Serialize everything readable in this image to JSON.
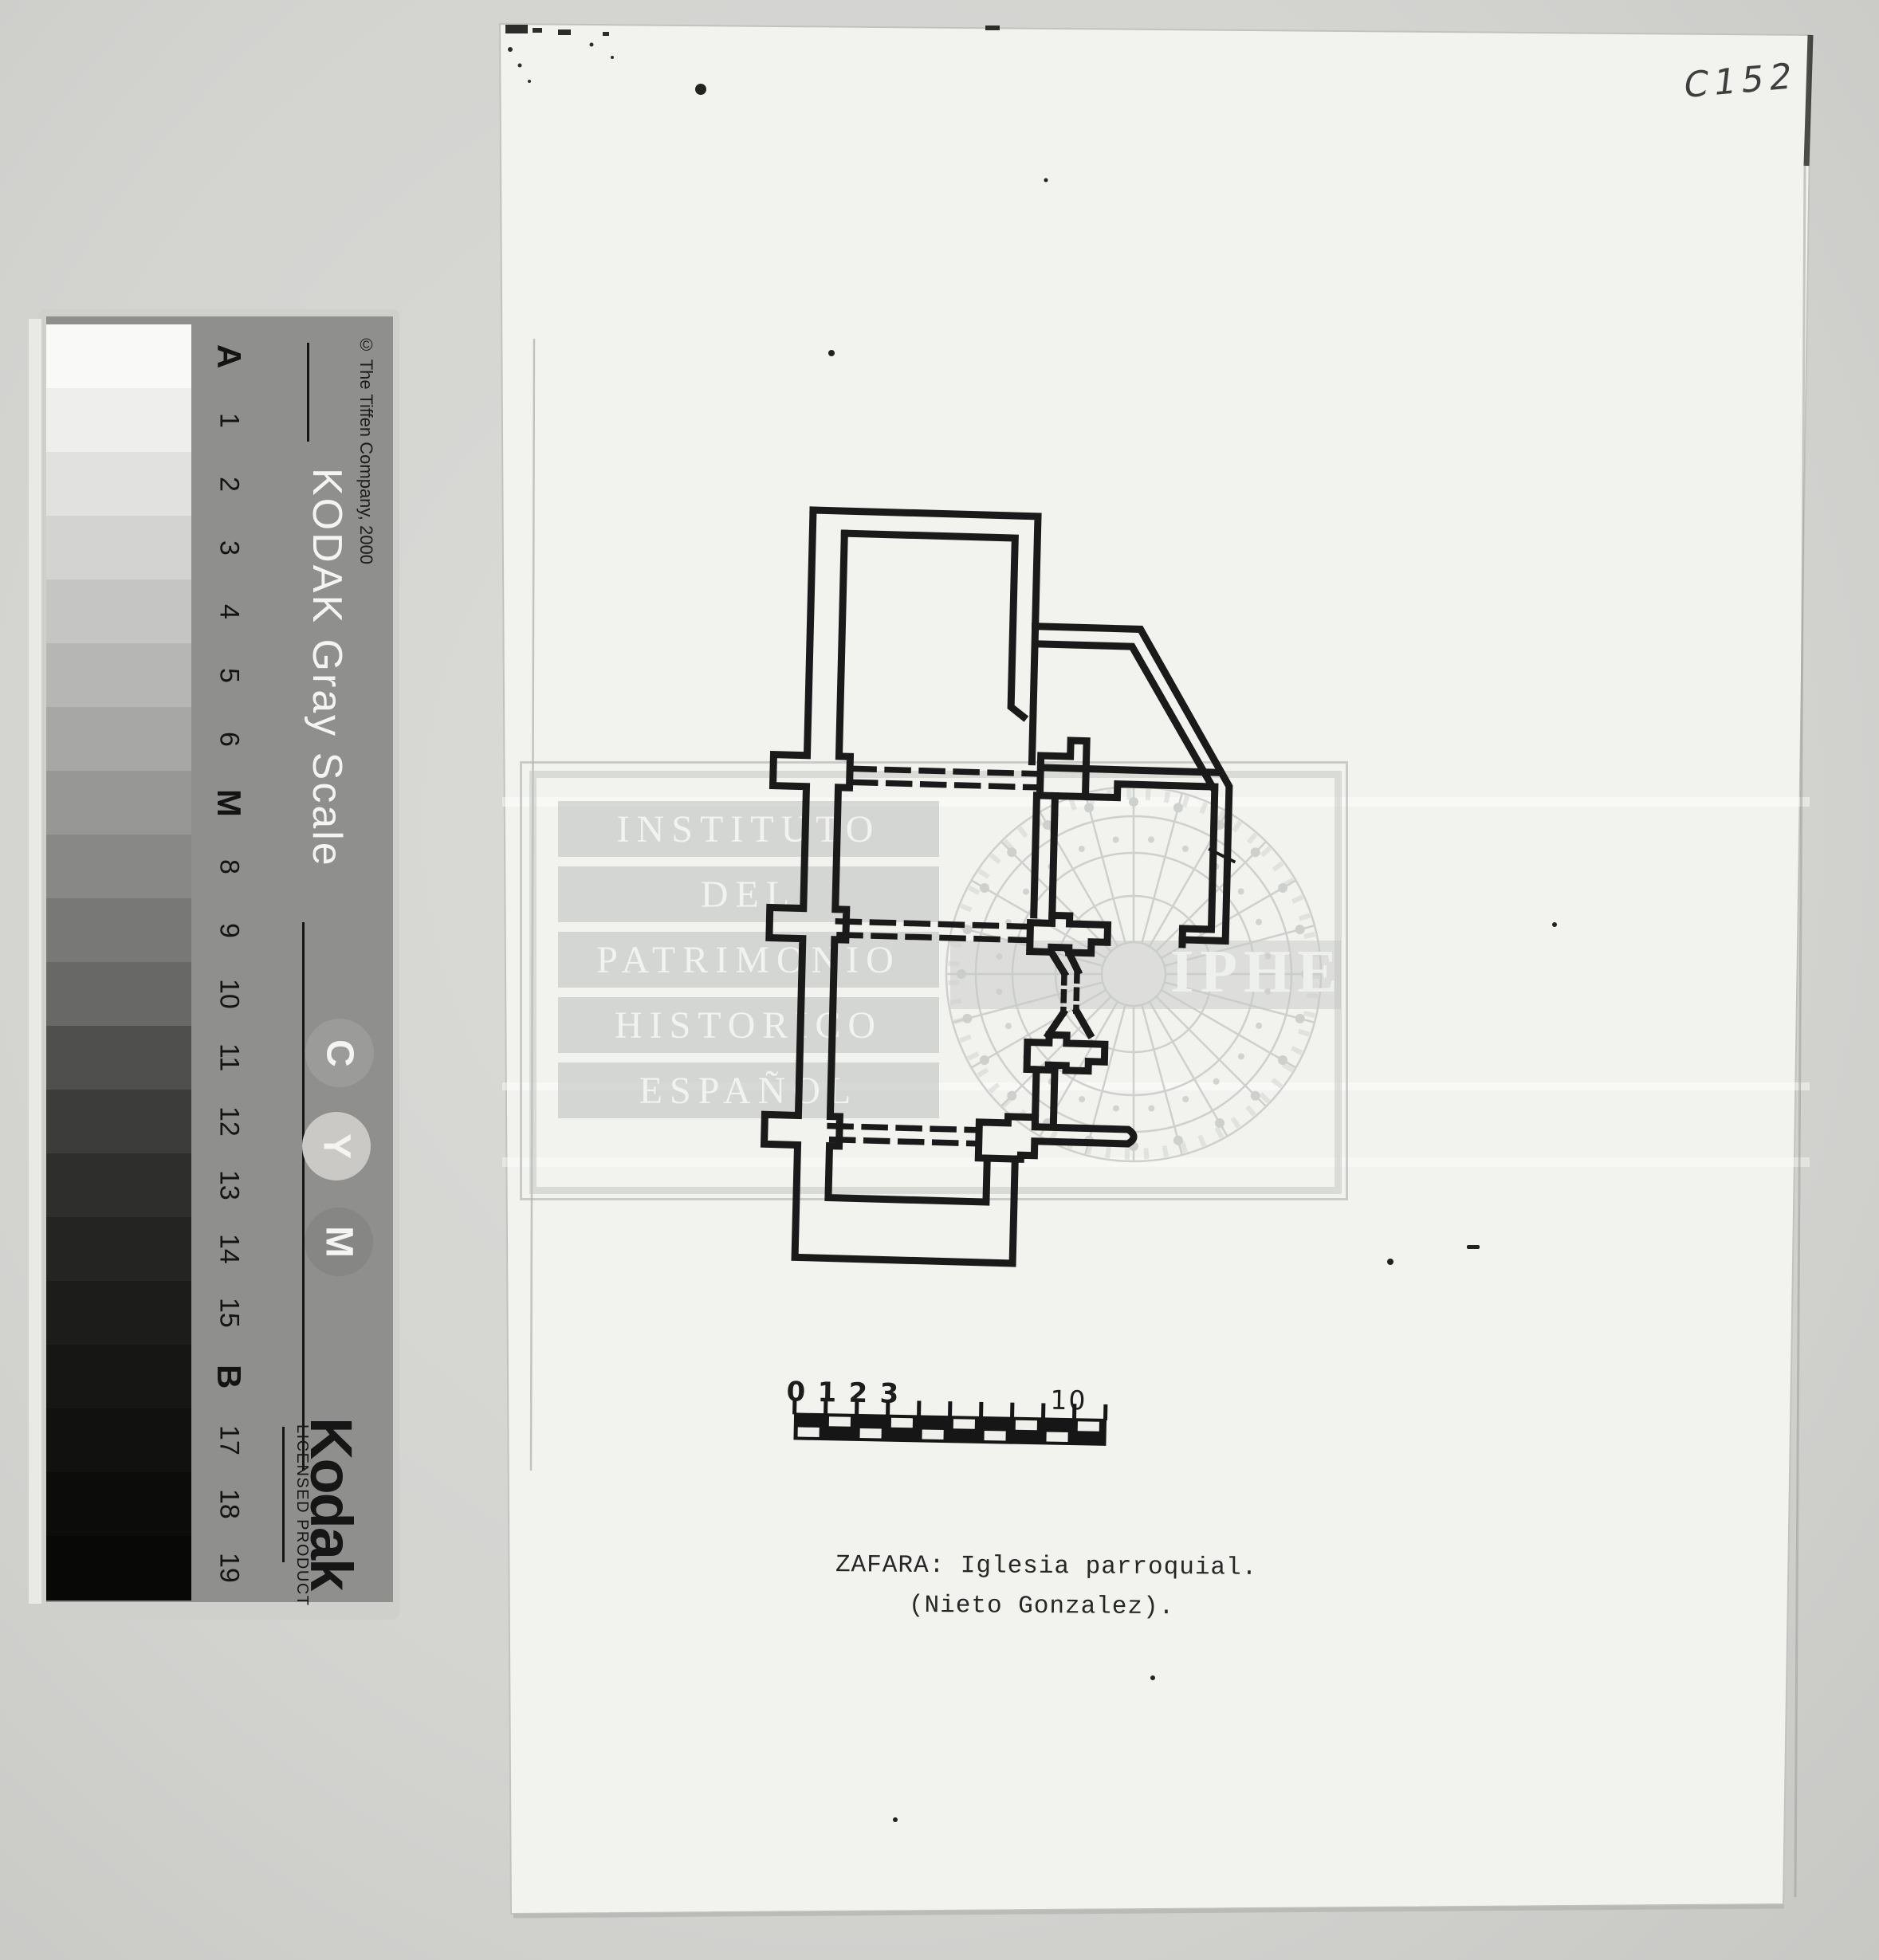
{
  "gray_scale_strip": {
    "copyright": "© The Tiffen Company, 2000",
    "title": "KODAK Gray Scale",
    "logo": "Kodak",
    "logo_sub": "LICENSED PRODUCT",
    "patches": [
      {
        "label": "A",
        "color": "#f9f9f7",
        "bold": true
      },
      {
        "label": "1",
        "color": "#eeeeec",
        "bold": false
      },
      {
        "label": "2",
        "color": "#e1e1df",
        "bold": false
      },
      {
        "label": "3",
        "color": "#d3d3d1",
        "bold": false
      },
      {
        "label": "4",
        "color": "#c5c5c3",
        "bold": false
      },
      {
        "label": "5",
        "color": "#b6b6b4",
        "bold": false
      },
      {
        "label": "6",
        "color": "#a7a7a5",
        "bold": false
      },
      {
        "label": "M",
        "color": "#979795",
        "bold": true
      },
      {
        "label": "8",
        "color": "#888886",
        "bold": false
      },
      {
        "label": "9",
        "color": "#787876",
        "bold": false
      },
      {
        "label": "10",
        "color": "#686866",
        "bold": false
      },
      {
        "label": "11",
        "color": "#4f4f4e",
        "bold": false
      },
      {
        "label": "12",
        "color": "#3c3c3b",
        "bold": false
      },
      {
        "label": "13",
        "color": "#2e2e2d",
        "bold": false
      },
      {
        "label": "14",
        "color": "#242423",
        "bold": false
      },
      {
        "label": "15",
        "color": "#1c1c1b",
        "bold": false
      },
      {
        "label": "B",
        "color": "#161615",
        "bold": true
      },
      {
        "label": "17",
        "color": "#111110",
        "bold": false
      },
      {
        "label": "18",
        "color": "#0c0c0b",
        "bold": false
      },
      {
        "label": "19",
        "color": "#080807",
        "bold": false
      }
    ],
    "cmy_circles": [
      {
        "letter": "C",
        "color": "#9b9b99"
      },
      {
        "letter": "Y",
        "color": "#cac9c6"
      },
      {
        "letter": "M",
        "color": "#868684"
      }
    ]
  },
  "sheet": {
    "handwritten_code": "C152",
    "watermark": {
      "lines": [
        "INSTITUTO",
        "DEL",
        "PATRIMONIO",
        "HISTORICO",
        "ESPAÑOL"
      ],
      "acronym": "IPHE"
    },
    "scale_bar": {
      "tick_labels": [
        "0",
        "1",
        "2",
        "3"
      ],
      "end_label": "10 ms."
    },
    "caption_line1": "ZAFARA: Iglesia parroquial.",
    "caption_line2": "(Nieto Gonzalez)."
  }
}
